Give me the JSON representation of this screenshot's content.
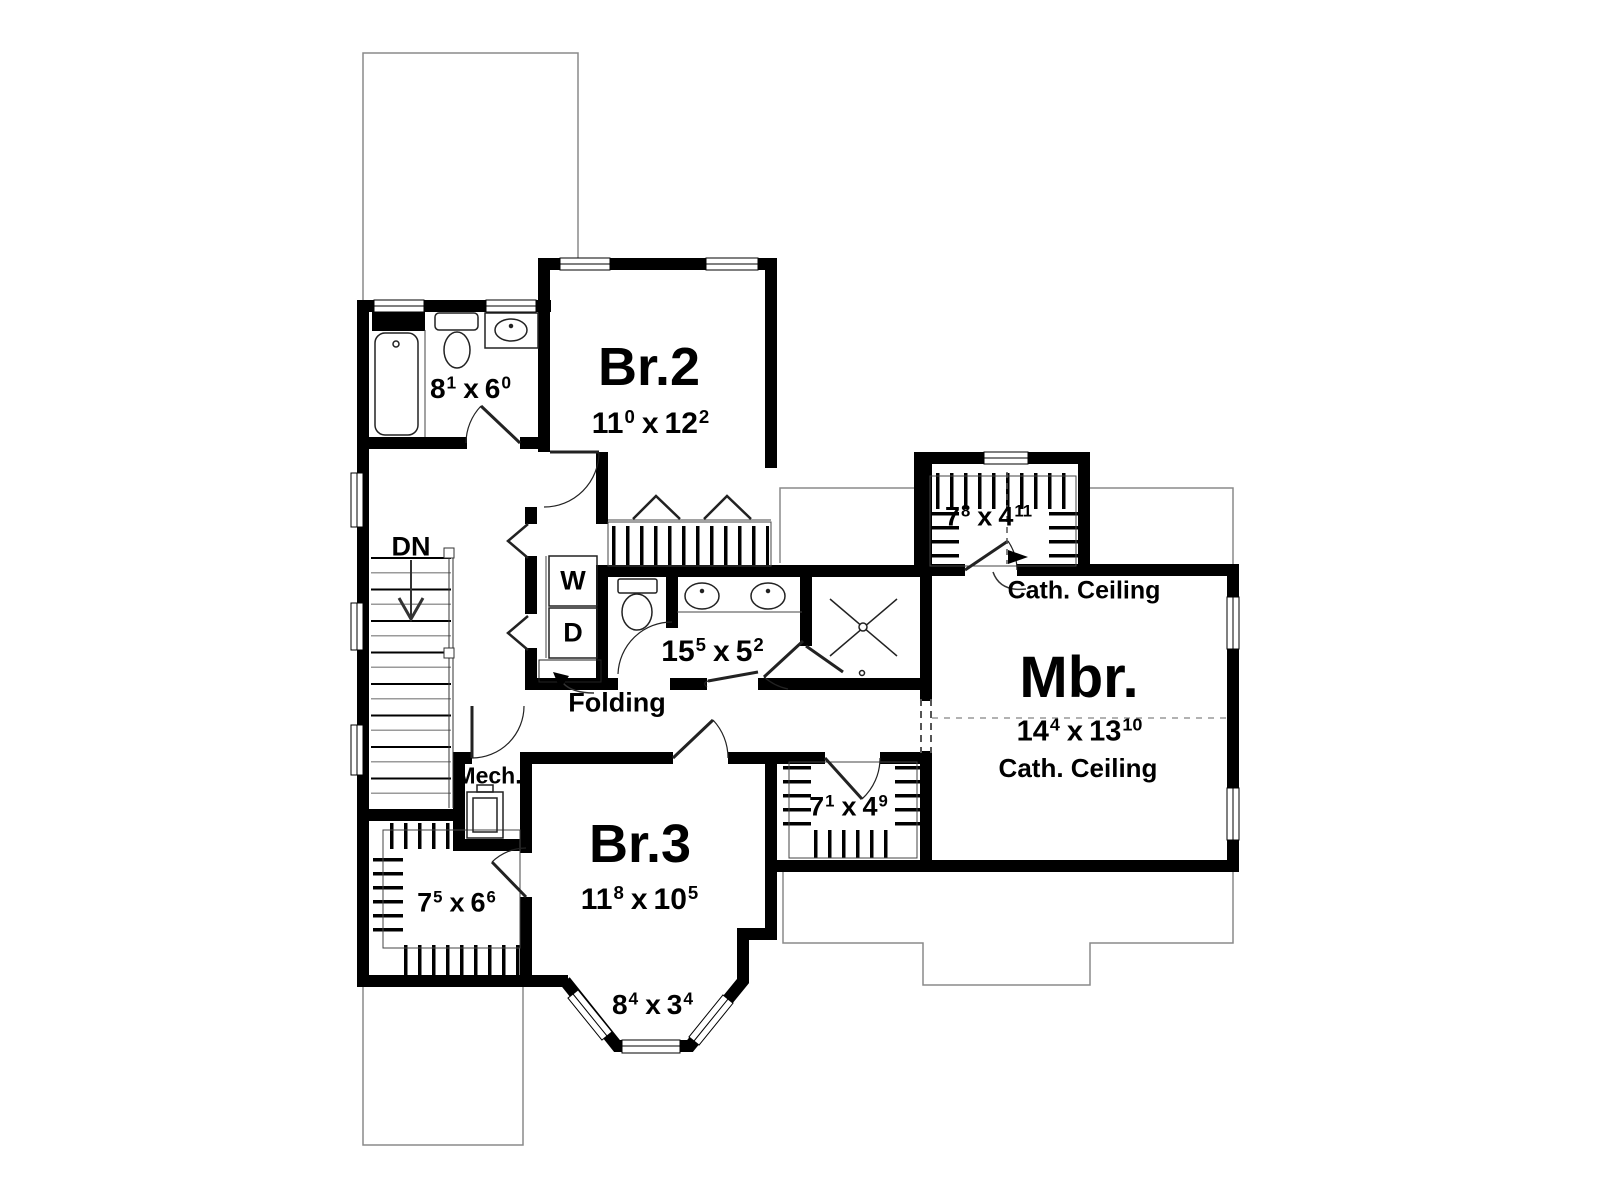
{
  "colors": {
    "wall": "#000000",
    "thin_outline": "#8a8a8a",
    "fixture_line": "#222222",
    "dash_line": "#777777",
    "background": "#ffffff"
  },
  "labels": {
    "down": "DN",
    "washer": "W",
    "dryer": "D",
    "folding": "Folding",
    "mechanical": "Mech.",
    "cath_ceiling_closet": "Cath. Ceiling",
    "cath_ceiling_mbr": "Cath. Ceiling"
  },
  "rooms": {
    "br2": {
      "name": "Br.2",
      "dim": {
        "a": "11",
        "as": "0",
        "x": "x",
        "b": "12",
        "bs": "2"
      }
    },
    "br3": {
      "name": "Br.3",
      "dim": {
        "a": "11",
        "as": "8",
        "x": "x",
        "b": "10",
        "bs": "5"
      }
    },
    "mbr": {
      "name": "Mbr.",
      "dim": {
        "a": "14",
        "as": "4",
        "x": "x",
        "b": "13",
        "bs": "10"
      }
    },
    "bath_upper": {
      "dim": {
        "a": "8",
        "as": "1",
        "x": "x",
        "b": "6",
        "bs": "0"
      }
    },
    "bath_main": {
      "dim": {
        "a": "15",
        "as": "5",
        "x": "x",
        "b": "5",
        "bs": "2"
      }
    },
    "closet_master": {
      "dim": {
        "a": "7",
        "as": "8",
        "x": "x",
        "b": "4",
        "bs": "11"
      }
    },
    "closet_hall": {
      "dim": {
        "a": "7",
        "as": "1",
        "x": "x",
        "b": "4",
        "bs": "9"
      }
    },
    "closet_bottom_left": {
      "dim": {
        "a": "7",
        "as": "5",
        "x": "x",
        "b": "6",
        "bs": "6"
      }
    },
    "bay_window": {
      "dim": {
        "a": "8",
        "as": "4",
        "x": "x",
        "b": "3",
        "bs": "4"
      }
    }
  }
}
